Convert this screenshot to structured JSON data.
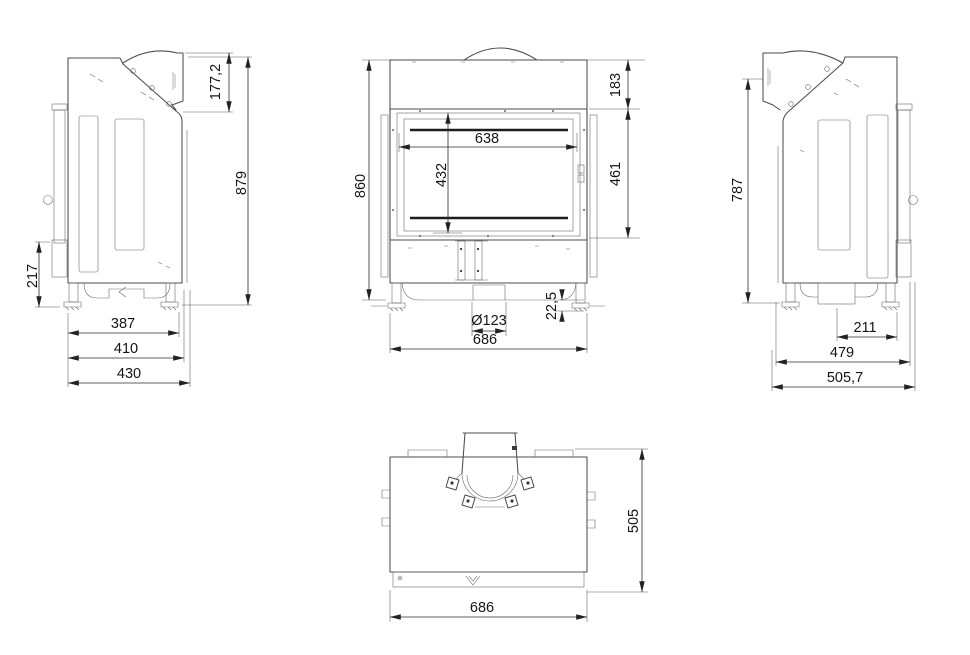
{
  "drawing": {
    "background_color": "#ffffff",
    "line_color": "#4d4d4d",
    "dimension_color": "#2b2b2b",
    "text_color": "#141414"
  },
  "views": {
    "left_side": {
      "dims": {
        "flue_section_height": "177,2",
        "overall_height": "879",
        "lower_front_height": "217",
        "base_width_inner": "387",
        "base_width_mid": "410",
        "base_width_outer": "430"
      }
    },
    "front": {
      "dims": {
        "top_band_height": "183",
        "door_area_height": "461",
        "glass_width": "638",
        "glass_height": "432",
        "overall_height": "860",
        "flue_diameter": "Ø123",
        "foot_height": "22,5",
        "overall_width": "686"
      }
    },
    "right_side": {
      "dims": {
        "overall_height": "787",
        "base_width_inner": "211",
        "base_width_mid": "479",
        "base_width_outer": "505,7"
      }
    },
    "top": {
      "dims": {
        "overall_depth": "505",
        "overall_width": "686"
      }
    }
  }
}
